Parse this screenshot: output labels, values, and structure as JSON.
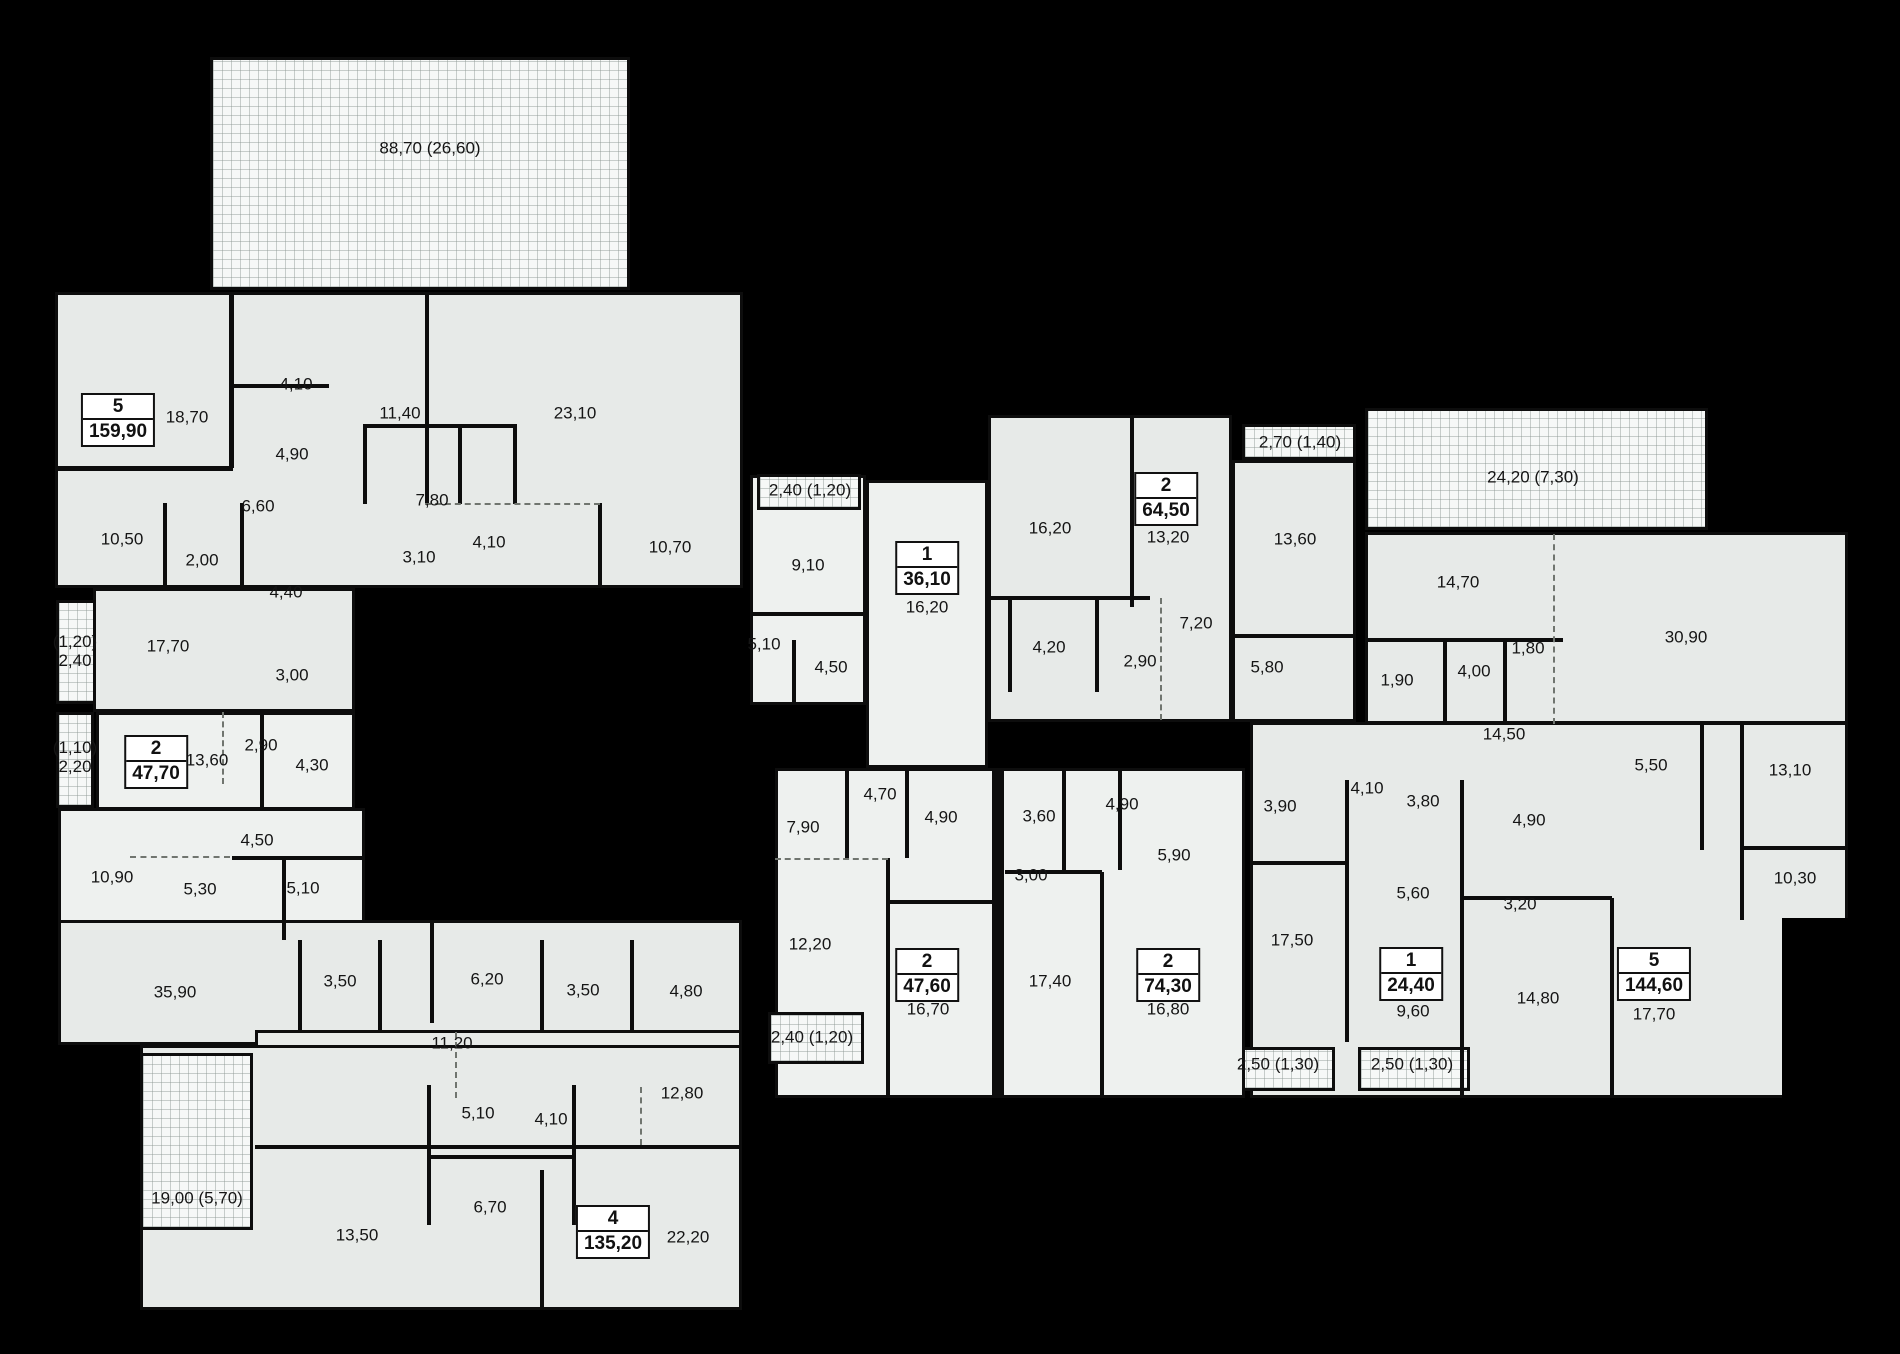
{
  "colors": {
    "background": "#000000",
    "room_fill": "#e7eae8",
    "room_fill_light": "#eef1ef",
    "hatch_fill": "#f6f8f7",
    "wall": "#0d0d0d",
    "label_text": "#151515"
  },
  "apartment_badges": [
    {
      "number": "5",
      "area": "159,90",
      "x": 118,
      "y": 420
    },
    {
      "number": "2",
      "area": "47,70",
      "x": 156,
      "y": 762
    },
    {
      "number": "4",
      "area": "135,20",
      "x": 613,
      "y": 1232
    },
    {
      "number": "1",
      "area": "36,10",
      "x": 927,
      "y": 568
    },
    {
      "number": "2",
      "area": "64,50",
      "x": 1166,
      "y": 499
    },
    {
      "number": "2",
      "area": "47,60",
      "x": 927,
      "y": 975
    },
    {
      "number": "2",
      "area": "74,30",
      "x": 1168,
      "y": 975
    },
    {
      "number": "1",
      "area": "24,40",
      "x": 1411,
      "y": 974
    },
    {
      "number": "5",
      "area": "144,60",
      "x": 1654,
      "y": 974
    }
  ],
  "room_labels": [
    {
      "text": "88,70 (26,60)",
      "x": 430,
      "y": 148
    },
    {
      "text": "18,70",
      "x": 187,
      "y": 417
    },
    {
      "text": "4,10",
      "x": 296,
      "y": 384
    },
    {
      "text": "11,40",
      "x": 400,
      "y": 413
    },
    {
      "text": "23,10",
      "x": 575,
      "y": 413
    },
    {
      "text": "4,90",
      "x": 292,
      "y": 454
    },
    {
      "text": "6,60",
      "x": 258,
      "y": 506
    },
    {
      "text": "7,80",
      "x": 432,
      "y": 500
    },
    {
      "text": "10,50",
      "x": 122,
      "y": 539
    },
    {
      "text": "2,00",
      "x": 202,
      "y": 560
    },
    {
      "text": "3,10",
      "x": 419,
      "y": 557
    },
    {
      "text": "4,10",
      "x": 489,
      "y": 542
    },
    {
      "text": "10,70",
      "x": 670,
      "y": 547
    },
    {
      "text": "4,40",
      "x": 286,
      "y": 592
    },
    {
      "text": "(1,20)\n2,40",
      "x": 75,
      "y": 651
    },
    {
      "text": "17,70",
      "x": 168,
      "y": 646
    },
    {
      "text": "3,00",
      "x": 292,
      "y": 675
    },
    {
      "text": "(1,10)\n2,20",
      "x": 75,
      "y": 757
    },
    {
      "text": "13,60",
      "x": 207,
      "y": 760
    },
    {
      "text": "2,90",
      "x": 261,
      "y": 745
    },
    {
      "text": "4,30",
      "x": 312,
      "y": 765
    },
    {
      "text": "4,50",
      "x": 257,
      "y": 840
    },
    {
      "text": "10,90",
      "x": 112,
      "y": 877
    },
    {
      "text": "5,30",
      "x": 200,
      "y": 889
    },
    {
      "text": "5,10",
      "x": 303,
      "y": 888
    },
    {
      "text": "35,90",
      "x": 175,
      "y": 992
    },
    {
      "text": "3,50",
      "x": 340,
      "y": 981
    },
    {
      "text": "6,20",
      "x": 487,
      "y": 979
    },
    {
      "text": "3,50",
      "x": 583,
      "y": 990
    },
    {
      "text": "4,80",
      "x": 686,
      "y": 991
    },
    {
      "text": "11,20",
      "x": 452,
      "y": 1043
    },
    {
      "text": "5,10",
      "x": 478,
      "y": 1113
    },
    {
      "text": "4,10",
      "x": 551,
      "y": 1119
    },
    {
      "text": "12,80",
      "x": 682,
      "y": 1093
    },
    {
      "text": "19,00 (5,70)",
      "x": 197,
      "y": 1198
    },
    {
      "text": "13,50",
      "x": 357,
      "y": 1235
    },
    {
      "text": "6,70",
      "x": 490,
      "y": 1207
    },
    {
      "text": "22,20",
      "x": 688,
      "y": 1237
    },
    {
      "text": "2,40 (1,20)",
      "x": 810,
      "y": 490
    },
    {
      "text": "9,10",
      "x": 808,
      "y": 565
    },
    {
      "text": "5,10",
      "x": 764,
      "y": 644
    },
    {
      "text": "4,50",
      "x": 831,
      "y": 667
    },
    {
      "text": "16,20",
      "x": 927,
      "y": 607
    },
    {
      "text": "16,20",
      "x": 1050,
      "y": 528
    },
    {
      "text": "13,20",
      "x": 1168,
      "y": 537
    },
    {
      "text": "2,70 (1,40)",
      "x": 1300,
      "y": 442
    },
    {
      "text": "13,60",
      "x": 1295,
      "y": 539
    },
    {
      "text": "7,20",
      "x": 1196,
      "y": 623
    },
    {
      "text": "4,20",
      "x": 1049,
      "y": 647
    },
    {
      "text": "2,90",
      "x": 1140,
      "y": 661
    },
    {
      "text": "5,80",
      "x": 1267,
      "y": 667
    },
    {
      "text": "24,20 (7,30)",
      "x": 1533,
      "y": 477
    },
    {
      "text": "14,70",
      "x": 1458,
      "y": 582
    },
    {
      "text": "30,90",
      "x": 1686,
      "y": 637
    },
    {
      "text": "1,80",
      "x": 1528,
      "y": 648
    },
    {
      "text": "4,00",
      "x": 1474,
      "y": 671
    },
    {
      "text": "1,90",
      "x": 1397,
      "y": 680
    },
    {
      "text": "14,50",
      "x": 1504,
      "y": 734
    },
    {
      "text": "5,50",
      "x": 1651,
      "y": 765
    },
    {
      "text": "13,10",
      "x": 1790,
      "y": 770
    },
    {
      "text": "4,10",
      "x": 1367,
      "y": 788
    },
    {
      "text": "3,80",
      "x": 1423,
      "y": 801
    },
    {
      "text": "4,90",
      "x": 1529,
      "y": 820
    },
    {
      "text": "3,90",
      "x": 1280,
      "y": 806
    },
    {
      "text": "10,30",
      "x": 1795,
      "y": 878
    },
    {
      "text": "5,60",
      "x": 1413,
      "y": 893
    },
    {
      "text": "3,20",
      "x": 1520,
      "y": 904
    },
    {
      "text": "17,50",
      "x": 1292,
      "y": 940
    },
    {
      "text": "9,60",
      "x": 1413,
      "y": 1011
    },
    {
      "text": "14,80",
      "x": 1538,
      "y": 998
    },
    {
      "text": "17,70",
      "x": 1654,
      "y": 1014
    },
    {
      "text": "2,50 (1,30)",
      "x": 1278,
      "y": 1064
    },
    {
      "text": "2,50 (1,30)",
      "x": 1412,
      "y": 1064
    },
    {
      "text": "7,90",
      "x": 803,
      "y": 827
    },
    {
      "text": "4,70",
      "x": 880,
      "y": 794
    },
    {
      "text": "4,90",
      "x": 941,
      "y": 817
    },
    {
      "text": "3,60",
      "x": 1039,
      "y": 816
    },
    {
      "text": "4,90",
      "x": 1122,
      "y": 804
    },
    {
      "text": "3,00",
      "x": 1031,
      "y": 875
    },
    {
      "text": "5,90",
      "x": 1174,
      "y": 855
    },
    {
      "text": "12,20",
      "x": 810,
      "y": 944
    },
    {
      "text": "16,70",
      "x": 928,
      "y": 1009
    },
    {
      "text": "17,40",
      "x": 1050,
      "y": 981
    },
    {
      "text": "16,80",
      "x": 1168,
      "y": 1009
    },
    {
      "text": "2,40 (1,20)",
      "x": 812,
      "y": 1037
    }
  ]
}
